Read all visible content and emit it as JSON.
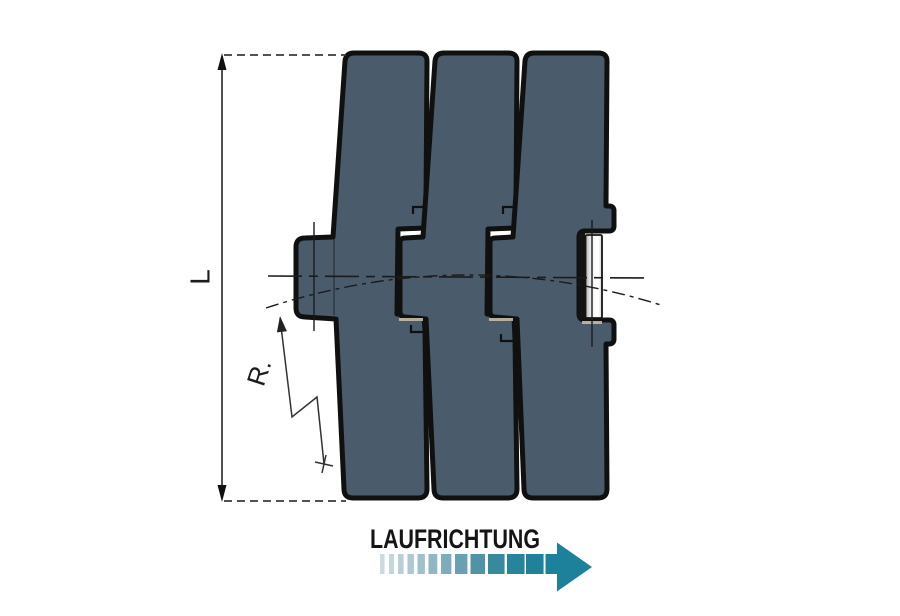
{
  "labels": {
    "length_dimension": "L",
    "radius": "R.",
    "direction": "LAUFRICHTUNG"
  },
  "colors": {
    "background": "#ffffff",
    "plate_fill": "#4a5c6b",
    "outline": "#101010",
    "accent_teal": "#1e819b",
    "pin_shade": "#aaaaaa",
    "pin_mid": "#e3e3e3",
    "pin_highlight": "#fbfbfb",
    "pin_edge": "#d5d5d5",
    "dim_line": "#3f3f3f",
    "leader": "#333333",
    "centerline": "#1b1b1b",
    "shadow_tan": "#c7bcaa"
  },
  "direction_arrow": {
    "bar_y": 554,
    "bar_h": 20,
    "segments": [
      {
        "x": 380.0,
        "w": 4.6,
        "color": "#ccdbe1"
      },
      {
        "x": 389.0,
        "w": 5.0,
        "color": "#c4d6dd"
      },
      {
        "x": 398.0,
        "w": 5.6,
        "color": "#b9d0d9"
      },
      {
        "x": 407.5,
        "w": 6.4,
        "color": "#adc8d3"
      },
      {
        "x": 417.5,
        "w": 7.4,
        "color": "#a0c0cd"
      },
      {
        "x": 428.5,
        "w": 8.8,
        "color": "#91b7c6"
      },
      {
        "x": 441.0,
        "w": 10.4,
        "color": "#7fabbd"
      },
      {
        "x": 455.0,
        "w": 12.4,
        "color": "#69a0b3"
      },
      {
        "x": 470.5,
        "w": 14.6,
        "color": "#5093a9"
      },
      {
        "x": 488.0,
        "w": 16.6,
        "color": "#37899f"
      },
      {
        "x": 507.0,
        "w": 17.6,
        "color": "#26849c"
      },
      {
        "x": 526.0,
        "w": 17.6,
        "color": "#1f829b"
      }
    ],
    "shaft": {
      "x": 545.5,
      "w": 12.5
    },
    "head": {
      "base_x": 557,
      "tip_x": 592,
      "top_y": 542.5,
      "bottom_y": 591.5,
      "mid_y": 567
    }
  }
}
